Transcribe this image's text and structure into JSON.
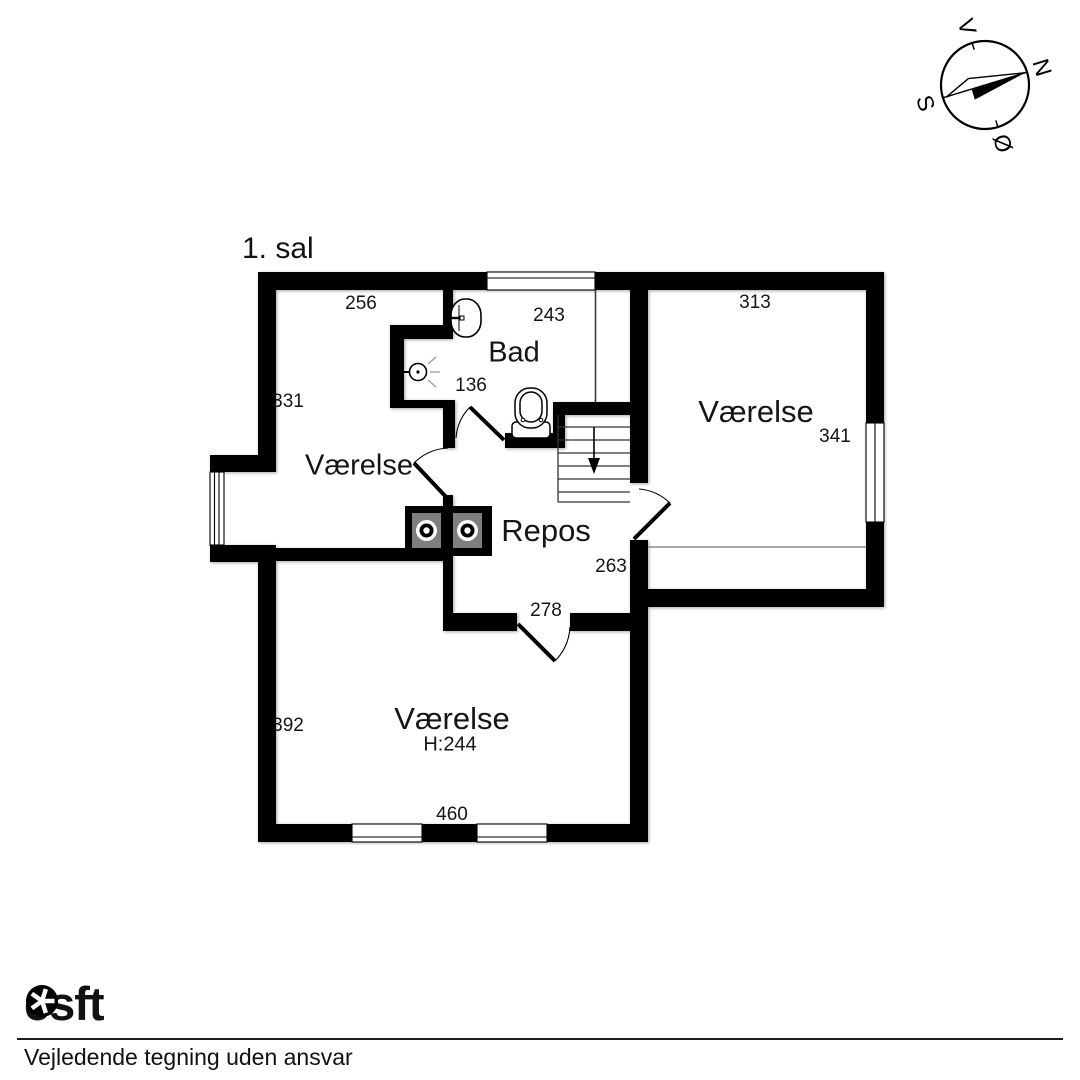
{
  "title": "1. sal",
  "compass": {
    "north": "N",
    "south": "S",
    "east": "Ø",
    "west": "V"
  },
  "rooms": {
    "bad": "Bad",
    "room_left": "Værelse",
    "room_right": "Værelse",
    "repos": "Repos",
    "room_lower": "Værelse",
    "room_lower_height": "H:244"
  },
  "dims": {
    "top_left_wall": "256",
    "bad_width": "243",
    "right_room_width": "313",
    "left_wall_upper": "331",
    "right_room_height": "341",
    "bad_alcove": "136",
    "repos_right": "263",
    "repos_bottom": "278",
    "lower_room_height": "392",
    "lower_room_width": "460"
  },
  "footer": {
    "brand_pre": "es",
    "brand_post": "ft",
    "disclaimer": "Vejledende tegning uden ansvar"
  },
  "colors": {
    "wall": "#000000",
    "appliance_gray": "#7f7f7f",
    "thin_line": "#8a8a8a"
  }
}
